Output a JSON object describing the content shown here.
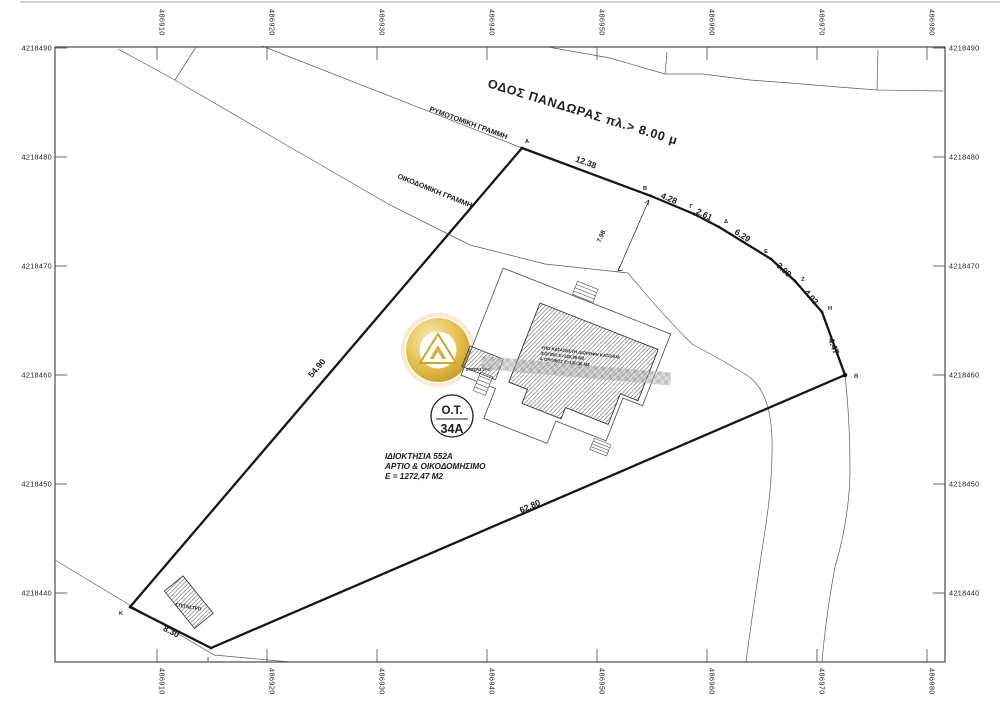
{
  "drawing": {
    "street": {
      "name": "ΟΔΟΣ ΠΑΝΔΩΡΑΣ πλ.> 8.00 μ"
    },
    "reference_lines": {
      "rymotomiki": "ΡΥΜΟΤΟΜΙΚΗ ΓΡΑΜΜΗ",
      "oikodomiki": "ΟΙΚΟΔΟΜΙΚΗ ΓΡΑΜΜΗ"
    },
    "block_badge": {
      "prefix": "O.T.",
      "number": "34A"
    },
    "property": {
      "line1": "ΙΔΙΟΚΤΗΣΙΑ 552Α",
      "line2": "ΑΡΤΙΟ & ΟΙΚΟΔΟΜΗΣΙΜΟ",
      "line3": "Ε = 1272,47 Μ2"
    },
    "building": {
      "line1": "ΥΠΟ ΚΑΤΑΣΚΕΥΗ ΔΙΩΡΟΦΗ ΚΑΤΟΙΚΙΑ",
      "line2": "ΙΣΟΓΕΙΟ Ε=130,36 Μ2",
      "line3": "Α ΟΡΟΦΟΣ Ε=130,36 Μ2"
    },
    "canopy_label": "ΣΤΕΓΑΣΤΡΟ",
    "canopy_label_2": "ΣΤΕΓΑΣΤΡΟ",
    "dimensions": {
      "ab": "12.38",
      "bg": "4.28",
      "gd": "2.61",
      "de": "6.29",
      "ez": "3.09",
      "zh": "4.02",
      "hth": "4.47",
      "ka": "54.90",
      "ith": "62.80",
      "ki": "8.30",
      "setback": "7.98"
    },
    "vertices": {
      "a": "A",
      "b": "B",
      "g": "Γ",
      "d": "Δ",
      "e": "E",
      "z": "Z",
      "h": "H",
      "th": "Θ",
      "i": "I",
      "k": "K"
    },
    "axes": {
      "eastings": [
        "486910",
        "486920",
        "486930",
        "486940",
        "486950",
        "486960",
        "486970",
        "486980"
      ],
      "northings": [
        "4218490",
        "4218480",
        "4218470",
        "4218460",
        "4218450",
        "4218440"
      ]
    },
    "watermark": {
      "faint_text": "Go"
    },
    "colors": {
      "paper": "#ffffff",
      "ink": "#1c1c1c",
      "gold_dark": "#b8860b",
      "gold_mid": "#d4a829",
      "gold_light": "#f9e9b0"
    }
  }
}
